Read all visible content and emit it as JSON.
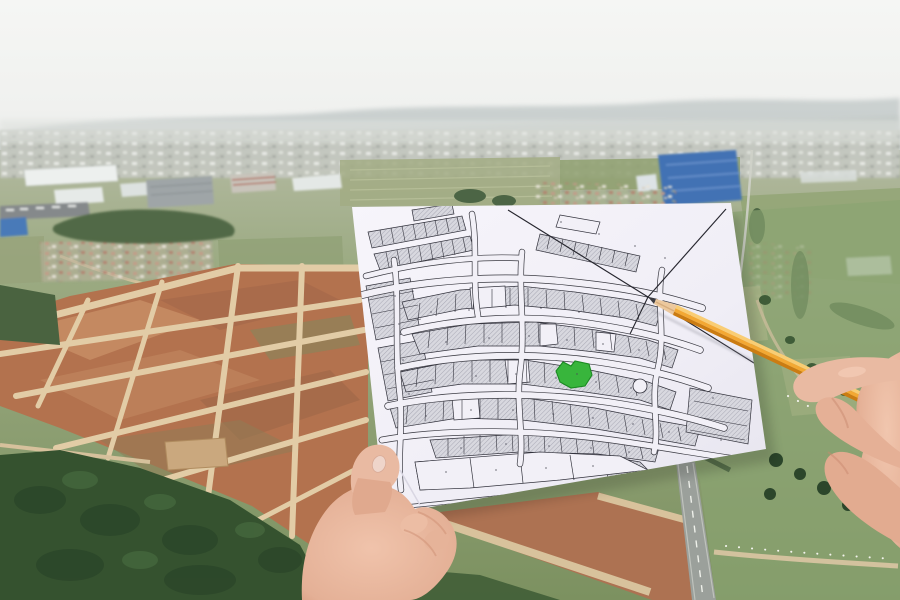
{
  "scene": {
    "description": "Aerial photograph of a land development area. A left hand holds a white cadastral plat-map sheet with one lot highlighted in green; a right hand points at the sheet with a sharpened yellow pencil.",
    "setting": "hazy white sky over distant industrial outskirts, red-earth subdivision site gridded with light dirt roads, green pastures, dark forest, an asphalt road at lower right",
    "objects": [
      "sky",
      "distant hills",
      "distant city band",
      "industrial warehouses",
      "blue factory building",
      "villages with red roofs",
      "tree clusters",
      "red-dirt development site with dirt-road grid",
      "forest",
      "pastures",
      "asphalt road with center line",
      "gravel path with fence posts",
      "white plat map paper",
      "cadastral lot grid",
      "green highlighted lot",
      "boundary survey lines",
      "cul-de-sac",
      "yellow pencil",
      "left hand holding paper",
      "right hand holding pencil"
    ]
  },
  "map": {
    "style": "black-line cadastral plat, hatched gray lots along curved street corridors, tiny illegible lot numbers",
    "highlighted_lot": "irregular green-filled lot near map center",
    "pointer": "pencil tip touches junction of boundary lines at upper right of plat"
  },
  "colors": {
    "sky_top": "#f4f5f3",
    "sky_horizon": "#e8eae7",
    "hills": "#b2bbba",
    "city_band": "#c5c8c0",
    "field_light": "#a5ae8b",
    "field_green": "#7e9261",
    "pasture": "#8ba471",
    "forest": "#35522f",
    "dirt": "#b3724e",
    "dirt_light": "#c88f66",
    "dirt_road": "#e2cca6",
    "asphalt": "#9ba09b",
    "paper": "#f2f0f7",
    "map_line": "#32323c",
    "lot_fill": "#d8d8df",
    "lot_hatch": "#a8a8b4",
    "highlight_lot": "#38b53c",
    "highlight_border": "#1b8a22",
    "pencil_body": "#f3a833",
    "pencil_highlight": "#f9cd74",
    "pencil_shade": "#cb7c12",
    "pencil_wood": "#ecc89d",
    "pencil_graphite": "#3c3c42",
    "skin": "#e9baa2",
    "skin_shadow": "#d29478",
    "nail": "#efd5ca",
    "blue_building": "#4272b4"
  }
}
